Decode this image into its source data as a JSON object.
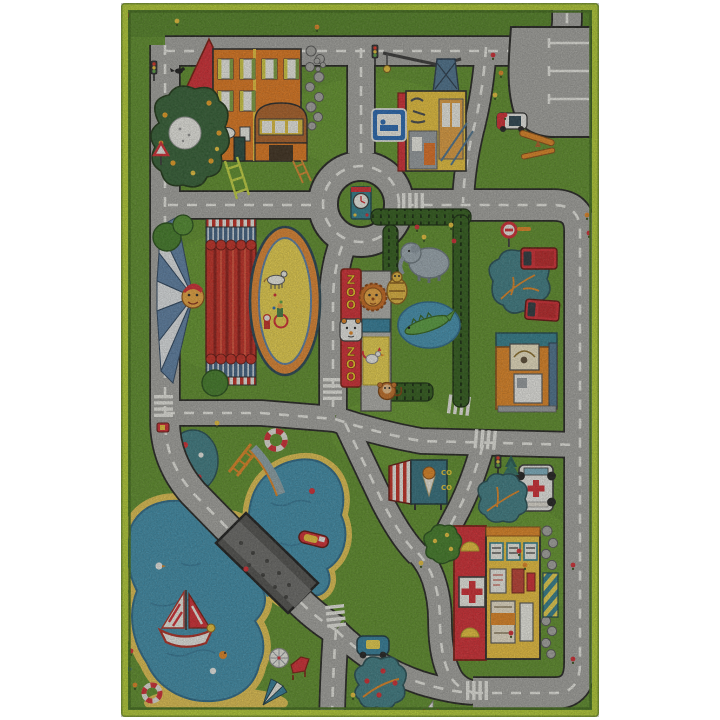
{
  "scene": {
    "type": "photo of a children's city road play rug on white background",
    "texts": {
      "zoo_sign_top": "ZOO",
      "zoo_sign_bottom": "ZOO",
      "ice_cream_sign": "CO CO"
    },
    "palette": {
      "page_bg": "#ffffff",
      "border_lime": "#b9d430",
      "border_dark": "#3f6d15",
      "grass": "#5d9126",
      "grass_dark": "#4f8220",
      "grass_light": "#6fa52e",
      "road": "#a8a8a4",
      "road_outline": "#1d1d1b",
      "road_dash": "#f2f2ec",
      "water": "#3b8fae",
      "water_dark": "#27688a",
      "sand": "#ecc94e",
      "bridge": "#4e4e4c",
      "roof_red": "#d9262e",
      "house_orange": "#e87818",
      "building_yellow": "#f5c73a",
      "teal": "#2e7f8f",
      "steel_blue": "#4a7290"
    },
    "features": [
      {
        "name": "house",
        "label": "Orange two-story house with red gable, garage and stone wall"
      },
      {
        "name": "apple-tree",
        "label": "Dark apple tree with white blossom ball"
      },
      {
        "name": "construction-site",
        "label": "Yellow building under construction with crane and blue sign"
      },
      {
        "name": "parking-lot",
        "label": "Gray parking lot with white bay markings"
      },
      {
        "name": "police-car",
        "label": "Small police car at parking entrance"
      },
      {
        "name": "roundabout-clock-tower",
        "label": "Roundabout with clock tower on green island"
      },
      {
        "name": "circus-carousel",
        "label": "Circus tent with clown face, red curtain and yellow show ring with horse"
      },
      {
        "name": "zoo",
        "label": "Zoo with hedges, elephant, lion, tiger, crocodile, monkey and rooster"
      },
      {
        "name": "zoo-sign",
        "label": "Red vertical ZOO sign with bear face",
        "text": "ZOO"
      },
      {
        "name": "kiosk-building",
        "label": "Orange kiosk with teal roof"
      },
      {
        "name": "red-trucks",
        "label": "Two red trucks parked by a tree"
      },
      {
        "name": "no-entry-sign",
        "label": "Round red no-entry sign"
      },
      {
        "name": "hospital",
        "label": "Yellow hospital with red wall, cross sign and striped awning"
      },
      {
        "name": "ambulance",
        "label": "White ambulance with red crosses"
      },
      {
        "name": "ice-cream-stand",
        "label": "Ice cream stand with red striped awning and cone",
        "text": "CO CO"
      },
      {
        "name": "traffic-light",
        "label": "Traffic lights"
      },
      {
        "name": "yield-sign",
        "label": "Red warning triangle sign"
      },
      {
        "name": "lake",
        "label": "Blue lake with yellow sandy shore"
      },
      {
        "name": "sailboat",
        "label": "Sailboat with red striped sails"
      },
      {
        "name": "motorboat",
        "label": "Small red motorboat"
      },
      {
        "name": "bridge",
        "label": "Dark cobblestone bridge crossing the lake"
      },
      {
        "name": "water-slide",
        "label": "Orange water slide into the lake"
      },
      {
        "name": "beach",
        "label": "Beach with umbrellas, red lounger, lifebuoy and ducks"
      },
      {
        "name": "blue-car",
        "label": "Blue car on bottom road"
      },
      {
        "name": "crosswalks",
        "label": "White zebra crosswalks"
      },
      {
        "name": "trees-and-flowers",
        "label": "Teal trees with fruit, bushes and small flowers"
      }
    ]
  }
}
